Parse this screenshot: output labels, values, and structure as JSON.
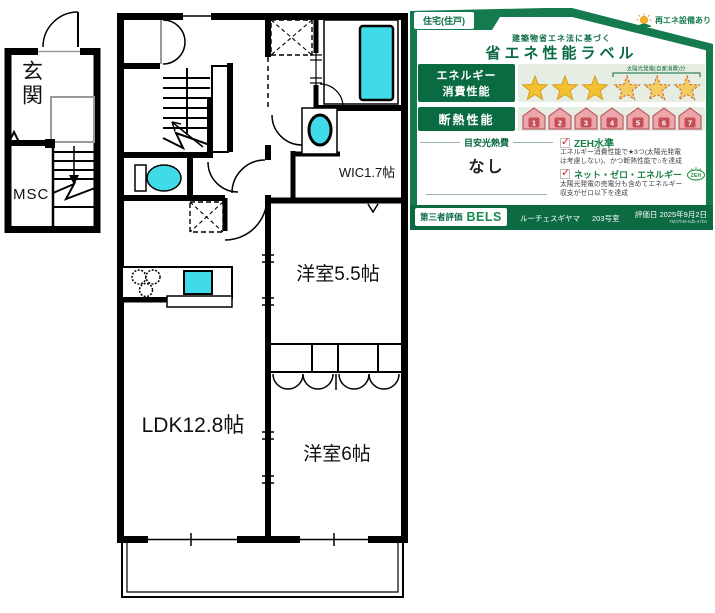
{
  "floor_plan": {
    "entrance_label": "玄関",
    "storage_label": "MSC",
    "wic_label": "WIC1.7帖",
    "bedroom1_label": "洋室5.5帖",
    "bedroom2_label": "洋室6帖",
    "ldk_label": "LDK12.8帖",
    "colors": {
      "room_yellow": "#F9F985",
      "fixture_cyan": "#3FDBE9",
      "wall": "#000000"
    }
  },
  "energy_label": {
    "type_badge": "住宅(住戸)",
    "renewable_badge": "再エネ設備あり",
    "law_note": "建築物省エネ法に基づく",
    "title": "省エネ性能ラベル",
    "energy": {
      "label_line1": "エネルギー",
      "label_line2": "消費性能",
      "solar_bracket_note": "太陽光発電(自家消費)分",
      "stars_total": 6,
      "stars_filled": 3,
      "stars_solar": 3
    },
    "insulation": {
      "label": "断熱性能",
      "levels": [
        1,
        2,
        3,
        4,
        5,
        6,
        7
      ]
    },
    "cost": {
      "label": "目安光熱費",
      "value": "なし"
    },
    "zeh_standard": {
      "label": "ZEH水準",
      "note_line1": "エネルギー消費性能で★3つ(太陽光発電",
      "note_line2": "は考慮しない)、かつ断熱性能で⌂を達成"
    },
    "net_zero": {
      "label": "ネット・ゼロ・エネルギー",
      "badge": "ZEH",
      "note_line1": "太陽光発電の売電分も含めてエネルギー",
      "note_line2": "収支がゼロ以下を達成"
    },
    "footer": {
      "evaluator_label": "第三者評価",
      "evaluator_name": "BELS",
      "property": "ルーチェスギヤマ",
      "unit": "203号室",
      "eval_date": "評価日 2025年9月2日",
      "code": "7M37bM-6db-47b0"
    },
    "colors": {
      "green": "#157A4E",
      "dark_green": "#0A6A42",
      "zone_bg": "#E6EDE2",
      "star_gold": "#F2C12E",
      "house_pink": "#EDA6A9"
    }
  }
}
